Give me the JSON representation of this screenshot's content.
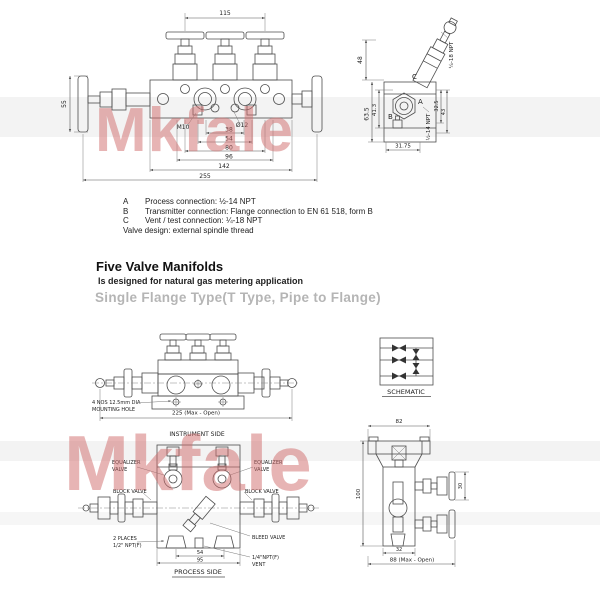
{
  "watermark": {
    "text": "Mkfale"
  },
  "top_front": {
    "dim_width": "115",
    "dim_handle": "55",
    "m10": "M10",
    "d12": "Ø12",
    "c38": "38",
    "c54": "54",
    "c80": "80",
    "c96": "96",
    "c142": "142",
    "c255": "255"
  },
  "top_side": {
    "h48": "48",
    "h63": "63.5",
    "h41": "41.3",
    "w31": "31.75",
    "r32": "32.5",
    "r43": "43",
    "a": "A",
    "b": "B",
    "c": "C",
    "npt18": "¼-18 NPT",
    "npt14": "½-14 NPT"
  },
  "legend": {
    "rows": [
      {
        "key": "A",
        "text": "Process connection: ½-14 NPT"
      },
      {
        "key": "B",
        "text": "Transmitter connection: Flange connection to EN 61 518, form B"
      },
      {
        "key": "C",
        "text": "Vent / test connection: ¼-18 NPT"
      }
    ],
    "note": "Valve design: external spindle thread"
  },
  "section": {
    "title": "Five Valve Manifolds",
    "subtitle": "Is designed for natural gas metering application",
    "variant": "Single Flange Type(T Type, Pipe to Flange)"
  },
  "middle": {
    "note1": "4 NOS 12.5mm DIA",
    "note2": "MOUNTING HOLE",
    "w225": "225 (Max - Open)"
  },
  "schematic": {
    "label": "SCHEMATIC"
  },
  "plan": {
    "instrument": "INSTRUMENT SIDE",
    "process": "PROCESS SIDE",
    "eq1": "EQUALIZER",
    "eq2": "VALVE",
    "block": "BLOCK VALVE",
    "bleed": "BLEED VALVE",
    "places1": "2 PLACES",
    "places2": "1/2\" NPT(F)",
    "vent1": "1/4\"NPT(F)",
    "vent2": "VENT",
    "d54": "54",
    "d95": "95"
  },
  "bside": {
    "w82": "82",
    "h100": "100",
    "r30": "30",
    "w32": "32",
    "w88": "88 (Max - Open)"
  }
}
